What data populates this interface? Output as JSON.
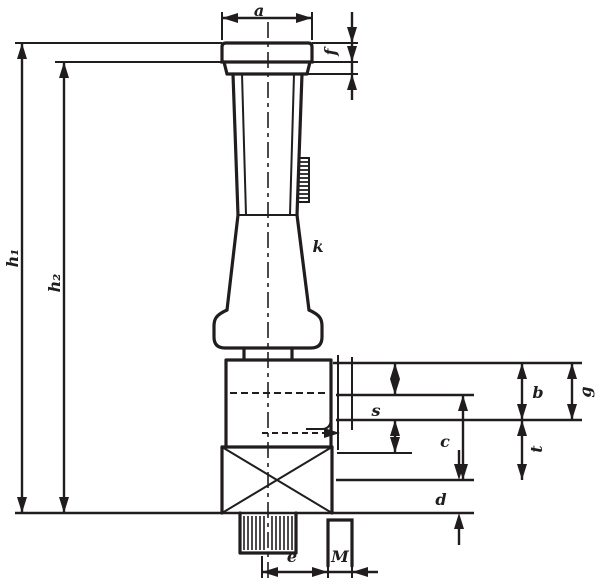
{
  "drawing": {
    "kind": "technical-dimension-drawing",
    "colors": {
      "ink": "#211d1e",
      "background": "#ffffff"
    }
  },
  "labels": {
    "a": "a",
    "f": "f",
    "h1": "h₁",
    "h2": "h₂",
    "k": "k",
    "s": "s",
    "c": "c",
    "b": "b",
    "g": "g",
    "t": "t",
    "d": "d",
    "e": "e",
    "M": "M"
  }
}
